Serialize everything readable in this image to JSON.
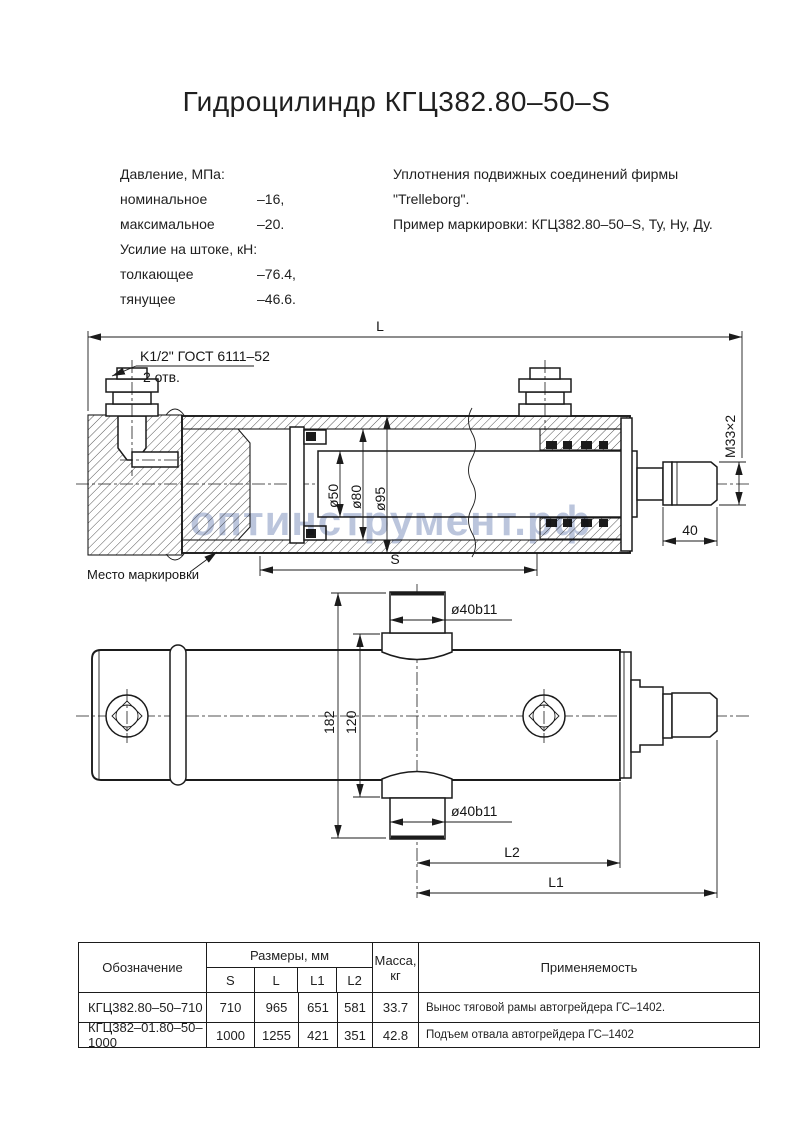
{
  "title": "Гидроцилиндр КГЦ382.80–50–S",
  "watermark": "оптинструмент.рф",
  "specs": {
    "pressure_header": "Давление, МПа:",
    "nominal_label": "номинальное",
    "nominal_value": "–16,",
    "max_label": "максимальное",
    "max_value": "–20.",
    "force_header": "Усилие на штоке, кН:",
    "push_label": "толкающее",
    "push_value": "–76.4,",
    "pull_label": "тянущее",
    "pull_value": "–46.6."
  },
  "seals": {
    "line1": "Уплотнения подвижных соединений фирмы",
    "line2": "\"Trelleborg\".",
    "line3": "Пример маркировки: КГЦ382.80–50–S, Ту, Ну, Ду."
  },
  "top_view": {
    "dim_overall": "L",
    "port_note_line1": "K1/2\" ГОСТ 6111–52",
    "port_note_line2": "2 отв.",
    "dim_rod": "ø50",
    "dim_piston": "ø80",
    "dim_bore": "ø95",
    "dim_thread": "М33×2",
    "dim_tip": "40",
    "dim_stroke": "S",
    "marking_note": "Место маркировки"
  },
  "bottom_view": {
    "dim_pin_top": "ø40b11",
    "dim_pin_bottom": "ø40b11",
    "dim_height": "182",
    "dim_flange": "120",
    "dim_l2": "L2",
    "dim_l1": "L1"
  },
  "table": {
    "col_designation": "Обозначение",
    "col_dimensions": "Размеры, мм",
    "col_s": "S",
    "col_l": "L",
    "col_l1": "L1",
    "col_l2": "L2",
    "col_mass_1": "Масса,",
    "col_mass_2": "кг",
    "col_application": "Применяемость",
    "rows": [
      {
        "designation": "КГЦ382.80–50–710",
        "s": "710",
        "l": "965",
        "l1": "651",
        "l2": "581",
        "mass": "33.7",
        "application": "Вынос тяговой рамы автогрейдера ГС–1402."
      },
      {
        "designation": "КГЦ382–01.80–50–1000",
        "s": "1000",
        "l": "1255",
        "l1": "421",
        "l2": "351",
        "mass": "42.8",
        "application": "Подъем отвала автогрейдера ГС–1402"
      }
    ]
  },
  "colors": {
    "ink": "#1b1b1b",
    "watermark": "#aab6d4"
  }
}
